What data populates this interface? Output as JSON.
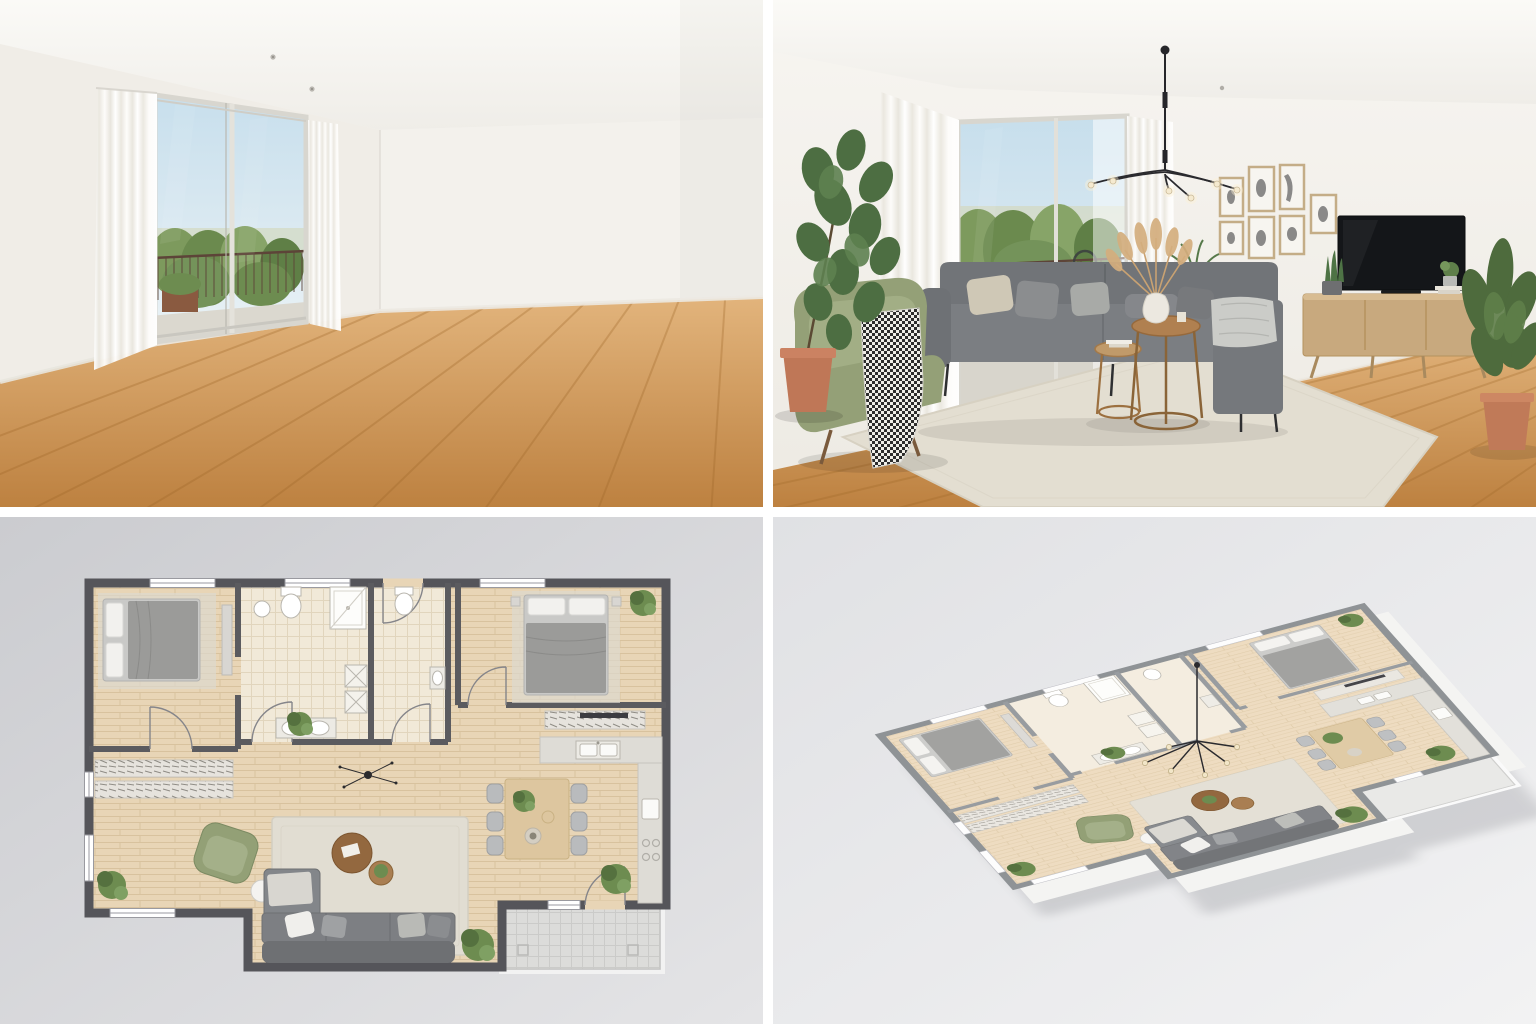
{
  "collage": {
    "layout": "2x2-grid",
    "gutter_color": "#ffffff",
    "panels": [
      {
        "id": "photo-empty",
        "type": "photograph",
        "label": "Empty living room with floor-to-ceiling sliding glass door, sheer white curtains, oak plank floor and balcony view of greenery"
      },
      {
        "id": "photo-staged",
        "type": "photograph",
        "label": "Virtually staged living room: charcoal sofa with chaise, olive green armchair with houndstooth throw, round nesting coffee tables with pampas vase, beige rug, black sputnik chandelier, gallery wall of framed prints, TV on oak sideboard, potted plants"
      },
      {
        "id": "plan-2d",
        "type": "floor-plan-2d",
        "label": "Top-down 2D furnished floor plan: two bedrooms, bathroom, WC, hallway, wardrobe wall, open living-dining-kitchen and terrace at lower right"
      },
      {
        "id": "plan-3d",
        "type": "floor-plan-3d",
        "label": "Isometric 3D furnished floor plan of the same apartment with white walls, gray wall caps and wood floors"
      }
    ],
    "depicted": {
      "bedrooms": 2,
      "bathrooms": 2,
      "dining_seats": 6,
      "gallery_frames": 7,
      "terrace": true
    },
    "palette": {
      "floor_oak": "#c8914f",
      "plan_wood": "#e8d5b6",
      "wall_white": "#f2f0ec",
      "plan_wall_gray": "#55555a",
      "iso_wall_cap": "#8f9396",
      "sofa_gray": "#75777a",
      "armchair_olive": "#94a077",
      "rug_beige": "#e1ddd2",
      "terracotta": "#c27a5a",
      "plant_green": "#5f7f4a",
      "sky_blue": "#c6deec",
      "tile_cream": "#f1e9d8",
      "terrace_gray": "#dcdcda",
      "background_gray": "#d9d9dc"
    }
  }
}
